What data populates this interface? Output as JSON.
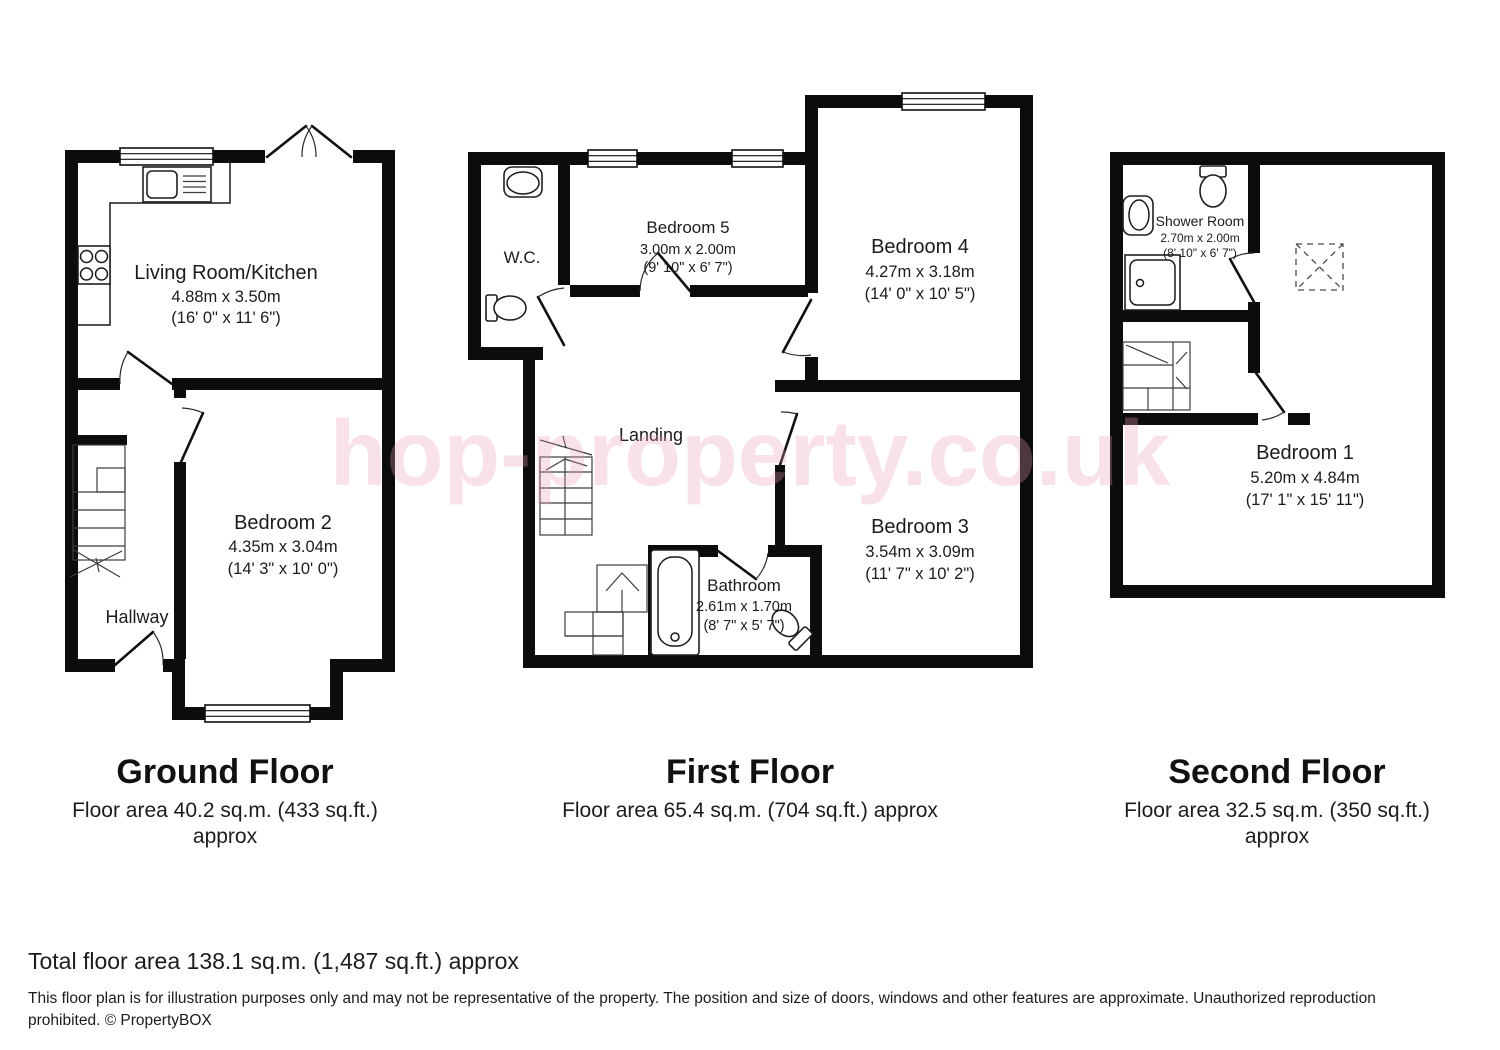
{
  "watermark": "hop-property.co.uk",
  "floors": {
    "ground": {
      "title": "Ground Floor",
      "area": "Floor area 40.2 sq.m. (433 sq.ft.)",
      "area2": "approx",
      "rooms": {
        "living_kitchen": {
          "name": "Living Room/Kitchen",
          "metric": "4.88m x 3.50m",
          "imperial": "(16' 0\" x 11' 6\")"
        },
        "bedroom2": {
          "name": "Bedroom 2",
          "metric": "4.35m x 3.04m",
          "imperial": "(14' 3\" x 10' 0\")"
        },
        "hallway": {
          "name": "Hallway"
        }
      }
    },
    "first": {
      "title": "First Floor",
      "area": "Floor area 65.4 sq.m. (704 sq.ft.) approx",
      "rooms": {
        "wc": {
          "name": "W.C."
        },
        "bedroom5": {
          "name": "Bedroom 5",
          "metric": "3.00m x 2.00m",
          "imperial": "(9' 10\" x 6' 7\")"
        },
        "bedroom4": {
          "name": "Bedroom 4",
          "metric": "4.27m x 3.18m",
          "imperial": "(14' 0\" x 10' 5\")"
        },
        "landing": {
          "name": "Landing"
        },
        "bathroom": {
          "name": "Bathroom",
          "metric": "2.61m x 1.70m",
          "imperial": "(8' 7\" x 5' 7\")"
        },
        "bedroom3": {
          "name": "Bedroom 3",
          "metric": "3.54m x 3.09m",
          "imperial": "(11' 7\" x 10' 2\")"
        }
      }
    },
    "second": {
      "title": "Second Floor",
      "area": "Floor area 32.5 sq.m. (350 sq.ft.)",
      "area2": "approx",
      "rooms": {
        "shower_room": {
          "name": "Shower Room",
          "metric": "2.70m x 2.00m",
          "imperial": "(8' 10\" x 6' 7\")"
        },
        "bedroom1": {
          "name": "Bedroom 1",
          "metric": "5.20m x 4.84m",
          "imperial": "(17' 1\" x 15' 11\")"
        }
      }
    }
  },
  "footer": {
    "total": "Total floor area 138.1 sq.m. (1,487 sq.ft.) approx",
    "disclaimer": "This floor plan is for illustration purposes only and may not be representative of the property. The position and size of doors, windows and other features are approximate. Unauthorized reproduction prohibited. © PropertyBOX"
  },
  "colors": {
    "wall": "#0c0c0c",
    "watermark_pink": "#ec9bbe"
  }
}
